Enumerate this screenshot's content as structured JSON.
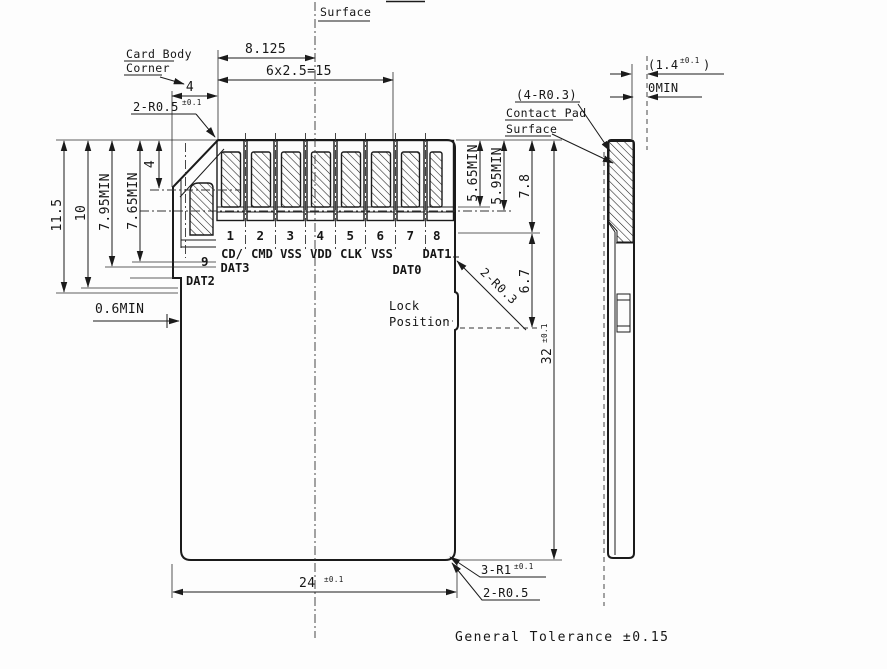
{
  "note": "General Tolerance ±0.15",
  "colors": {
    "ink": "#1b1b1b",
    "paper": "#fdfdfd"
  },
  "callouts": {
    "surface": "Surface",
    "card_body_corner_1": "Card Body",
    "card_body_corner_2": "Corner",
    "corner_radius": "2-R0.5",
    "corner_radius_tol": "±0.1",
    "pad_corner_radius": "(4-R0.3)",
    "contact_pad_1": "Contact Pad",
    "contact_pad_2": "Surface",
    "lock_1": "Lock",
    "lock_2": "Position",
    "lock_radius": "2-R0.3",
    "bottom_corner_radius": "3-R1",
    "bottom_corner_radius_tol": "±0.1",
    "bottom_edge_radius": "2-R0.5"
  },
  "dims": {
    "top_offset": "8.125",
    "pitch": "6x2.5=15",
    "chamfer_width": "4",
    "chamfer_height": "4",
    "d11_5": "11.5",
    "d10": "10",
    "d7_95": "7.95MIN",
    "d7_65": "7.65MIN",
    "d0_6": "0.6MIN",
    "d5_65": "5.65MIN",
    "d5_95": "5.95MIN",
    "d7_8": "7.8",
    "d6_7": "6.7",
    "height": "32",
    "height_tol": "±0.1",
    "width": "24",
    "width_tol": "±0.1",
    "thickness_open": "(1.4",
    "thickness_tol": "±0.1",
    "thickness_close": ")",
    "zero_min": "0MIN"
  },
  "pins": [
    {
      "num": "1",
      "line1": "CD/",
      "line2": "DAT3"
    },
    {
      "num": "2",
      "line1": "CMD"
    },
    {
      "num": "3",
      "line1": "VSS"
    },
    {
      "num": "4",
      "line1": "VDD"
    },
    {
      "num": "5",
      "line1": "CLK"
    },
    {
      "num": "6",
      "line1": "VSS"
    },
    {
      "num": "7",
      "line2": "DAT0"
    },
    {
      "num": "8",
      "line1": "DAT1"
    },
    {
      "num": "9",
      "line2": "DAT2"
    }
  ]
}
